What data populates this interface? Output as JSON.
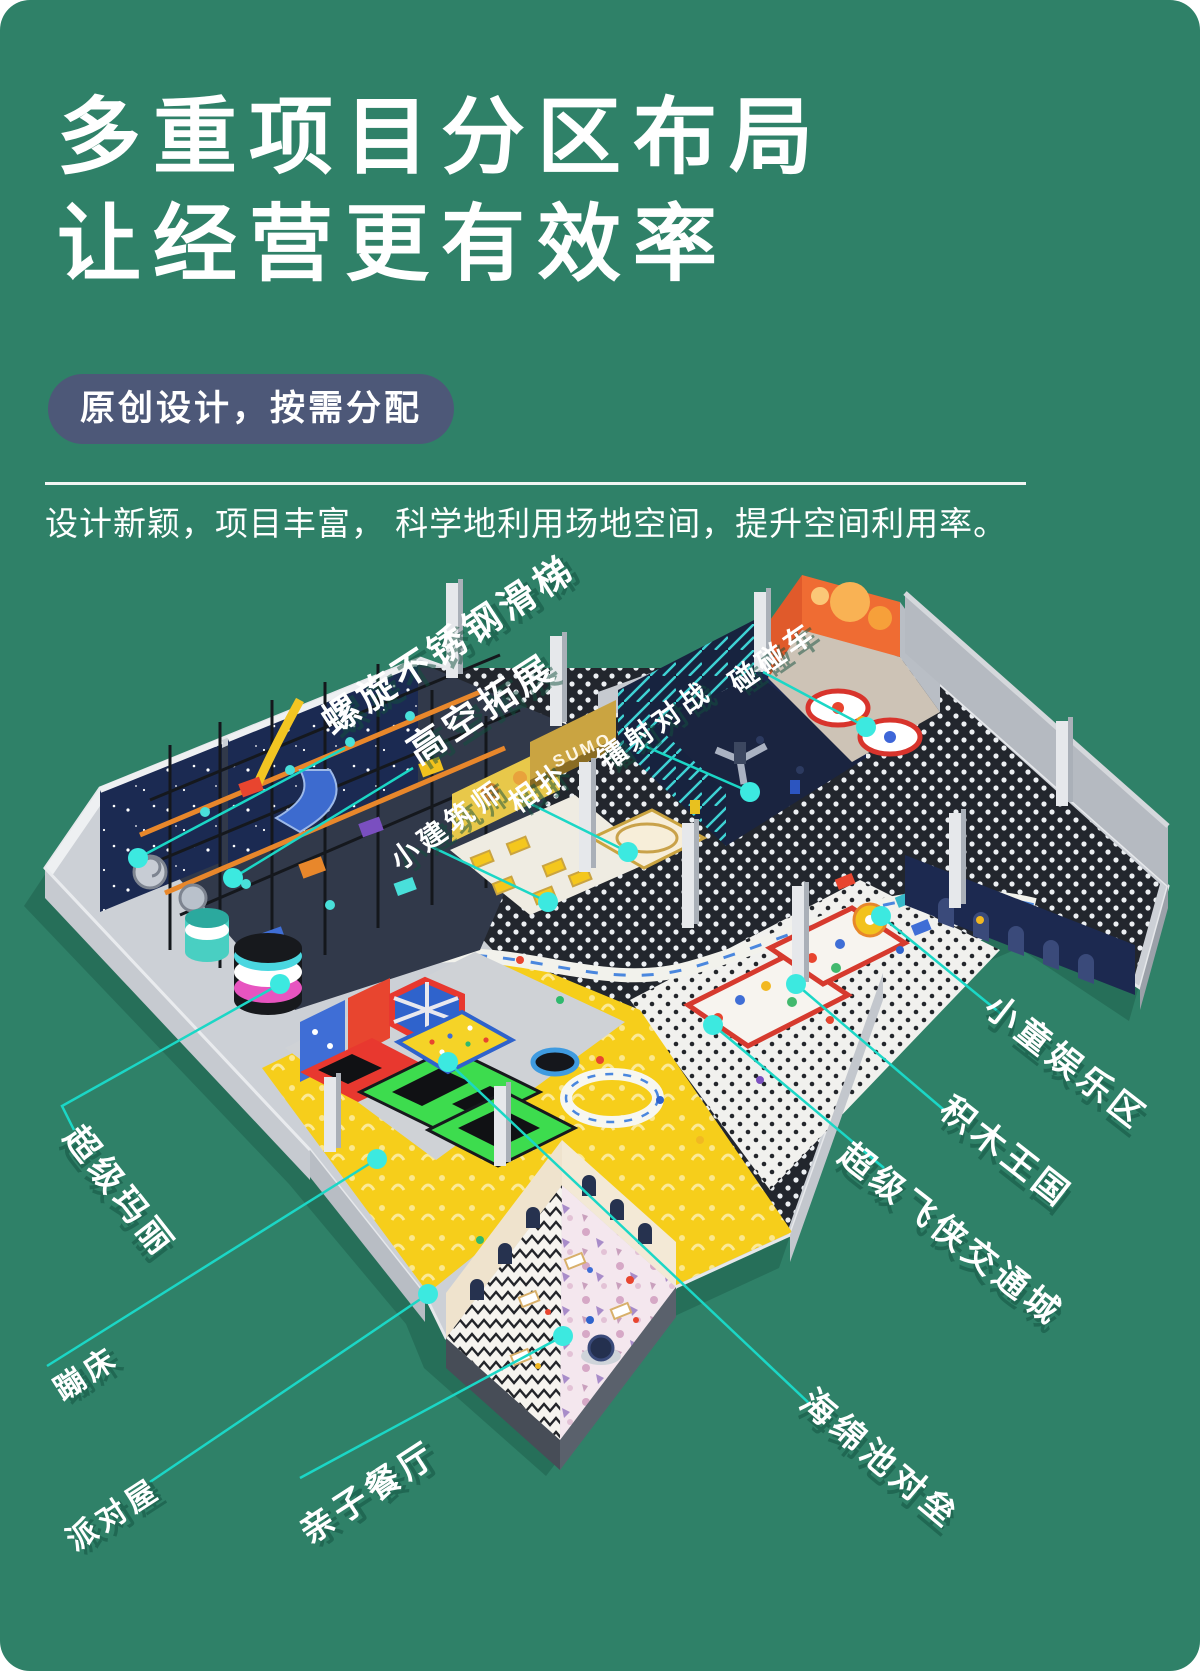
{
  "header": {
    "title_line1": "多重项目分区布局",
    "title_line2": "让经营更有效率",
    "badge": "原创设计，按需分配",
    "subtitle": "设计新颖，项目丰富， 科学地利用场地空间，提升空间利用率。"
  },
  "colors": {
    "background": "#2F8168",
    "badge_bg": "#4D5878",
    "leader_line": "#1BD7C6",
    "leader_dot": "#3CE9E0",
    "label_shadow": "rgba(17,80,62,0.5)"
  },
  "map_labels": [
    {
      "id": "zone-label-spiral-slide",
      "text": "螺旋不锈钢滑梯",
      "x": 447,
      "y": 642,
      "rotate": -33,
      "size": 37,
      "points": [
        [
          345,
          748
        ],
        [
          138,
          858
        ]
      ]
    },
    {
      "id": "zone-label-high-ropes",
      "text": "高空拓展",
      "x": 480,
      "y": 706,
      "rotate": -33,
      "size": 37,
      "points": [
        [
          413,
          768
        ],
        [
          233,
          878
        ]
      ]
    },
    {
      "id": "zone-label-little-architect",
      "text": "小建筑师",
      "x": 447,
      "y": 824,
      "rotate": -35,
      "size": 28,
      "points": [
        [
          430,
          846
        ],
        [
          548,
          902
        ]
      ]
    },
    {
      "id": "zone-label-sumo",
      "text": "相扑",
      "x": 538,
      "y": 786,
      "rotate": -35,
      "size": 28,
      "points": [
        [
          523,
          800
        ],
        [
          628,
          852
        ]
      ]
    },
    {
      "id": "zone-label-laser-battle",
      "text": "镭射对战",
      "x": 654,
      "y": 724,
      "rotate": -35,
      "size": 28,
      "points": [
        [
          640,
          744
        ],
        [
          750,
          792
        ]
      ]
    },
    {
      "id": "zone-label-bumper-cars",
      "text": "碰碰车",
      "x": 772,
      "y": 656,
      "rotate": -35,
      "size": 28,
      "points": [
        [
          763,
          672
        ],
        [
          866,
          727
        ]
      ]
    },
    {
      "id": "zone-label-kids-zone",
      "text": "小童娱乐区",
      "x": 1068,
      "y": 1060,
      "rotate": 38,
      "size": 34,
      "points": [
        [
          1000,
          1013
        ],
        [
          881,
          916
        ]
      ]
    },
    {
      "id": "zone-label-block-kingdom",
      "text": "积木王国",
      "x": 1008,
      "y": 1150,
      "rotate": 38,
      "size": 34,
      "points": [
        [
          944,
          1110
        ],
        [
          796,
          984
        ]
      ]
    },
    {
      "id": "zone-label-superwings-city",
      "text": "超级飞侠交通城",
      "x": 953,
      "y": 1232,
      "rotate": 38,
      "size": 34,
      "points": [
        [
          884,
          1168
        ],
        [
          713,
          1025
        ]
      ]
    },
    {
      "id": "zone-label-sponge-pool",
      "text": "海绵池对垒",
      "x": 882,
      "y": 1457,
      "rotate": 40,
      "size": 34,
      "points": [
        [
          812,
          1406
        ],
        [
          448,
          1062
        ]
      ]
    },
    {
      "id": "zone-label-super-mario",
      "text": "超级玛丽",
      "x": 122,
      "y": 1190,
      "rotate": 52,
      "size": 34,
      "points": [
        [
          74,
          1130
        ],
        [
          62,
          1106
        ],
        [
          280,
          984
        ]
      ]
    },
    {
      "id": "zone-label-trampoline",
      "text": "蹦床",
      "x": 85,
      "y": 1371,
      "rotate": -33,
      "size": 30,
      "points": [
        [
          47,
          1366
        ],
        [
          377,
          1159
        ]
      ]
    },
    {
      "id": "zone-label-party-house",
      "text": "派对屋",
      "x": 112,
      "y": 1512,
      "rotate": -33,
      "size": 30,
      "points": [
        [
          150,
          1482
        ],
        [
          428,
          1294
        ]
      ]
    },
    {
      "id": "zone-label-family-restaurant",
      "text": "亲子餐厅",
      "x": 367,
      "y": 1490,
      "rotate": -33,
      "size": 34,
      "points": [
        [
          300,
          1478
        ],
        [
          563,
          1336
        ]
      ]
    }
  ],
  "scene_texts": [
    {
      "id": "sumo-sign",
      "text": "SUMO",
      "x": 556,
      "y": 768,
      "rotate": -24,
      "size": 17,
      "color": "#FEF6E4",
      "spacing": 3
    }
  ]
}
